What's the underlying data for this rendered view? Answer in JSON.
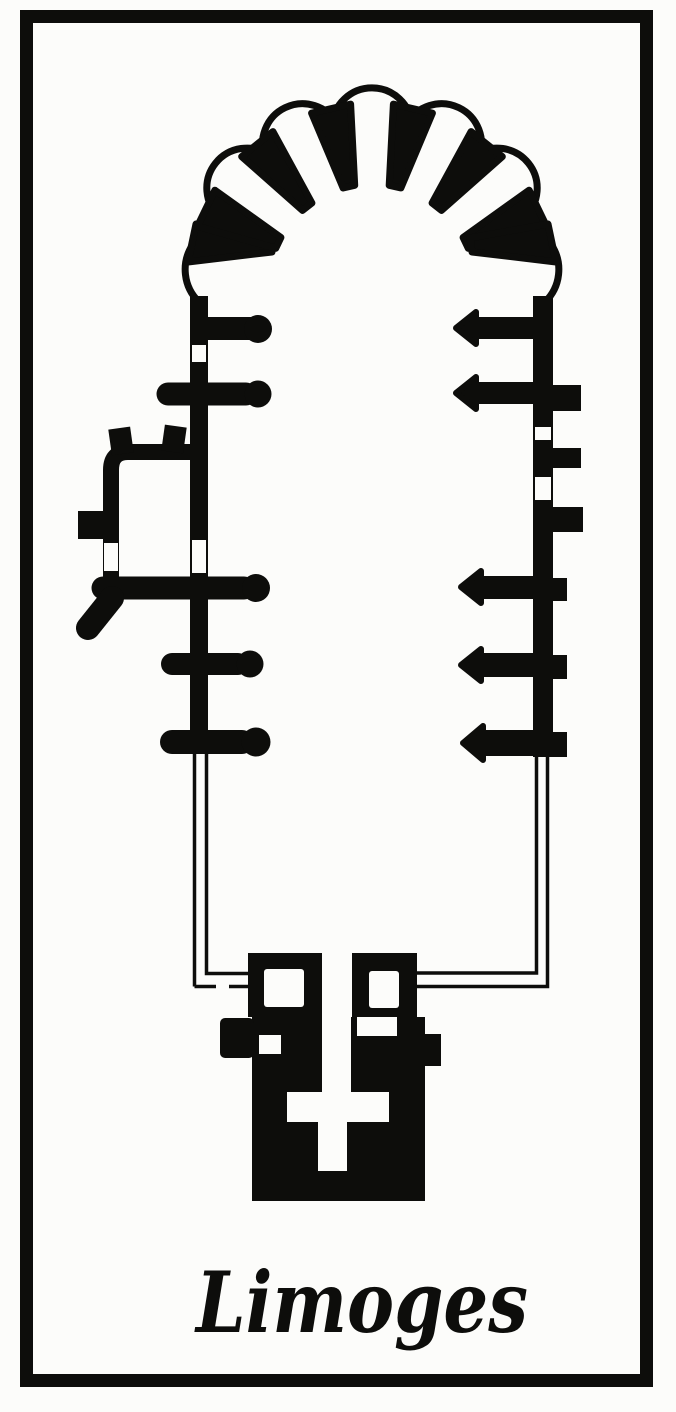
{
  "figure": {
    "caption": "Limoges"
  },
  "palette": {
    "ink": "#0d0d0b",
    "paper": "#fcfcfa"
  }
}
